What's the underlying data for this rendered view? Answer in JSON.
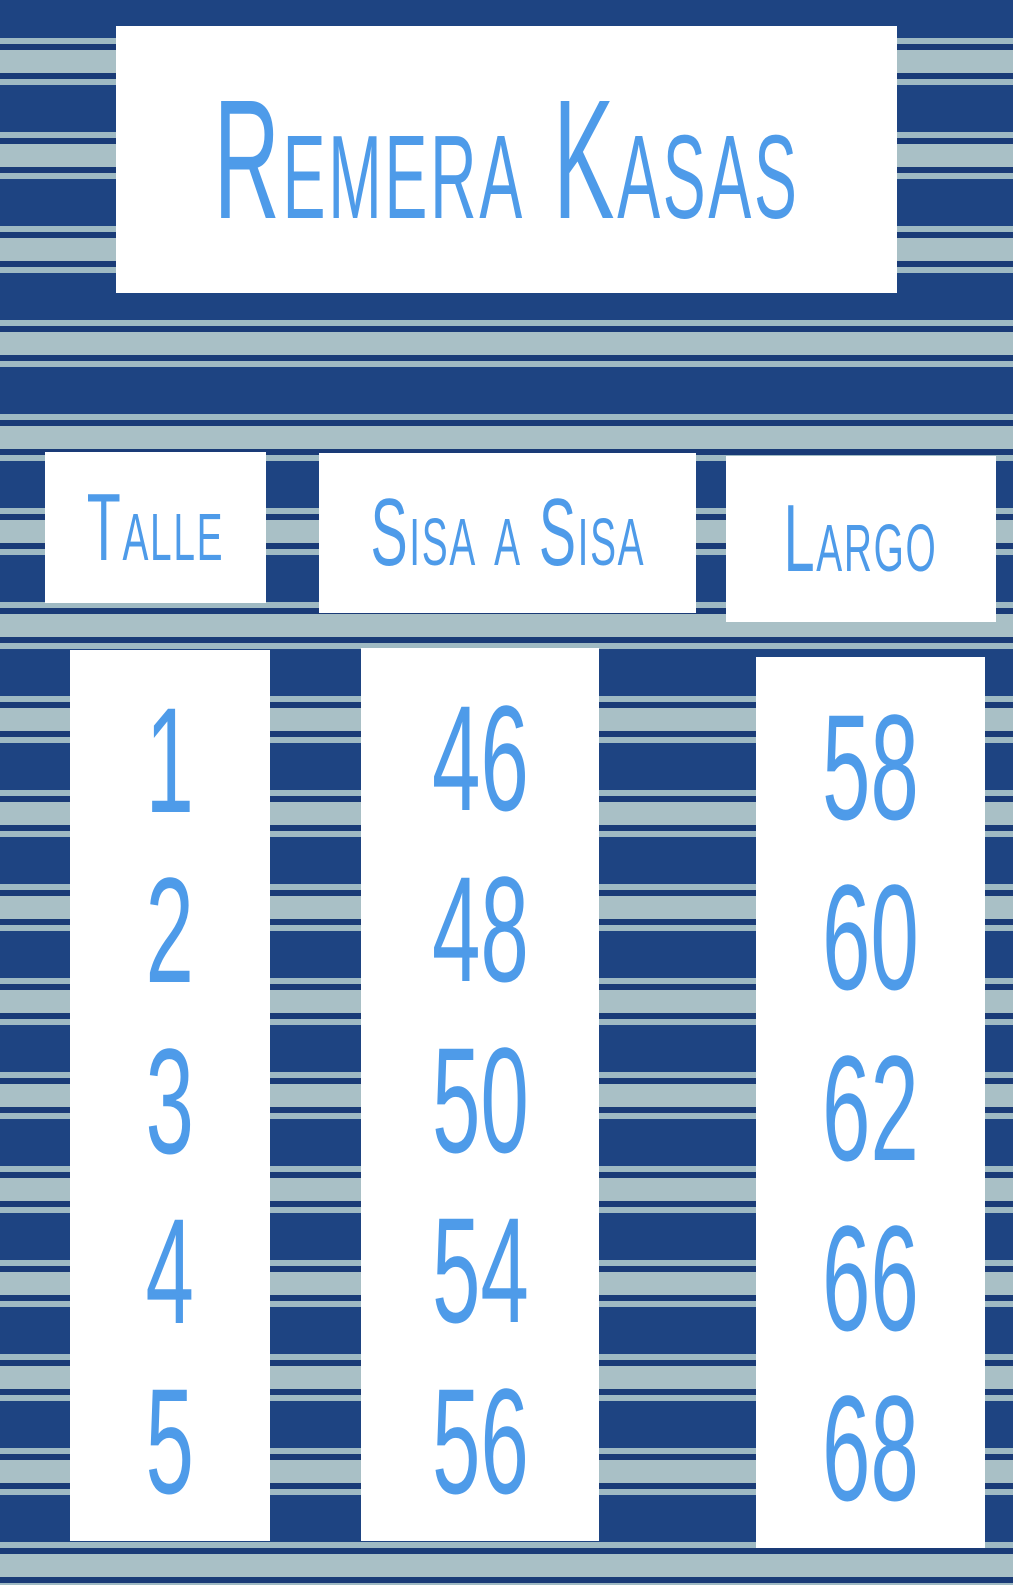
{
  "title": "Remera Kasas",
  "table": {
    "columns": [
      {
        "header": "Talle",
        "values": [
          "1",
          "2",
          "3",
          "4",
          "5"
        ]
      },
      {
        "header": "Sisa a Sisa",
        "values": [
          "46",
          "48",
          "50",
          "54",
          "56"
        ]
      },
      {
        "header": "Largo",
        "values": [
          "58",
          "60",
          "62",
          "66",
          "68"
        ]
      }
    ]
  },
  "colors": {
    "navy": "#1e4482",
    "navy_thin": "#1a3b77",
    "stripe_light": "#a9c0c6",
    "stripe_light_thin": "#9fbac3",
    "text_blue": "#4e9be9",
    "panel_white": "#ffffff"
  },
  "chart_data": {
    "type": "table",
    "title": "Remera Kasas",
    "columns": [
      "Talle",
      "Sisa a Sisa",
      "Largo"
    ],
    "rows": [
      [
        1,
        46,
        58
      ],
      [
        2,
        48,
        60
      ],
      [
        3,
        50,
        62
      ],
      [
        4,
        54,
        66
      ],
      [
        5,
        56,
        68
      ]
    ]
  }
}
